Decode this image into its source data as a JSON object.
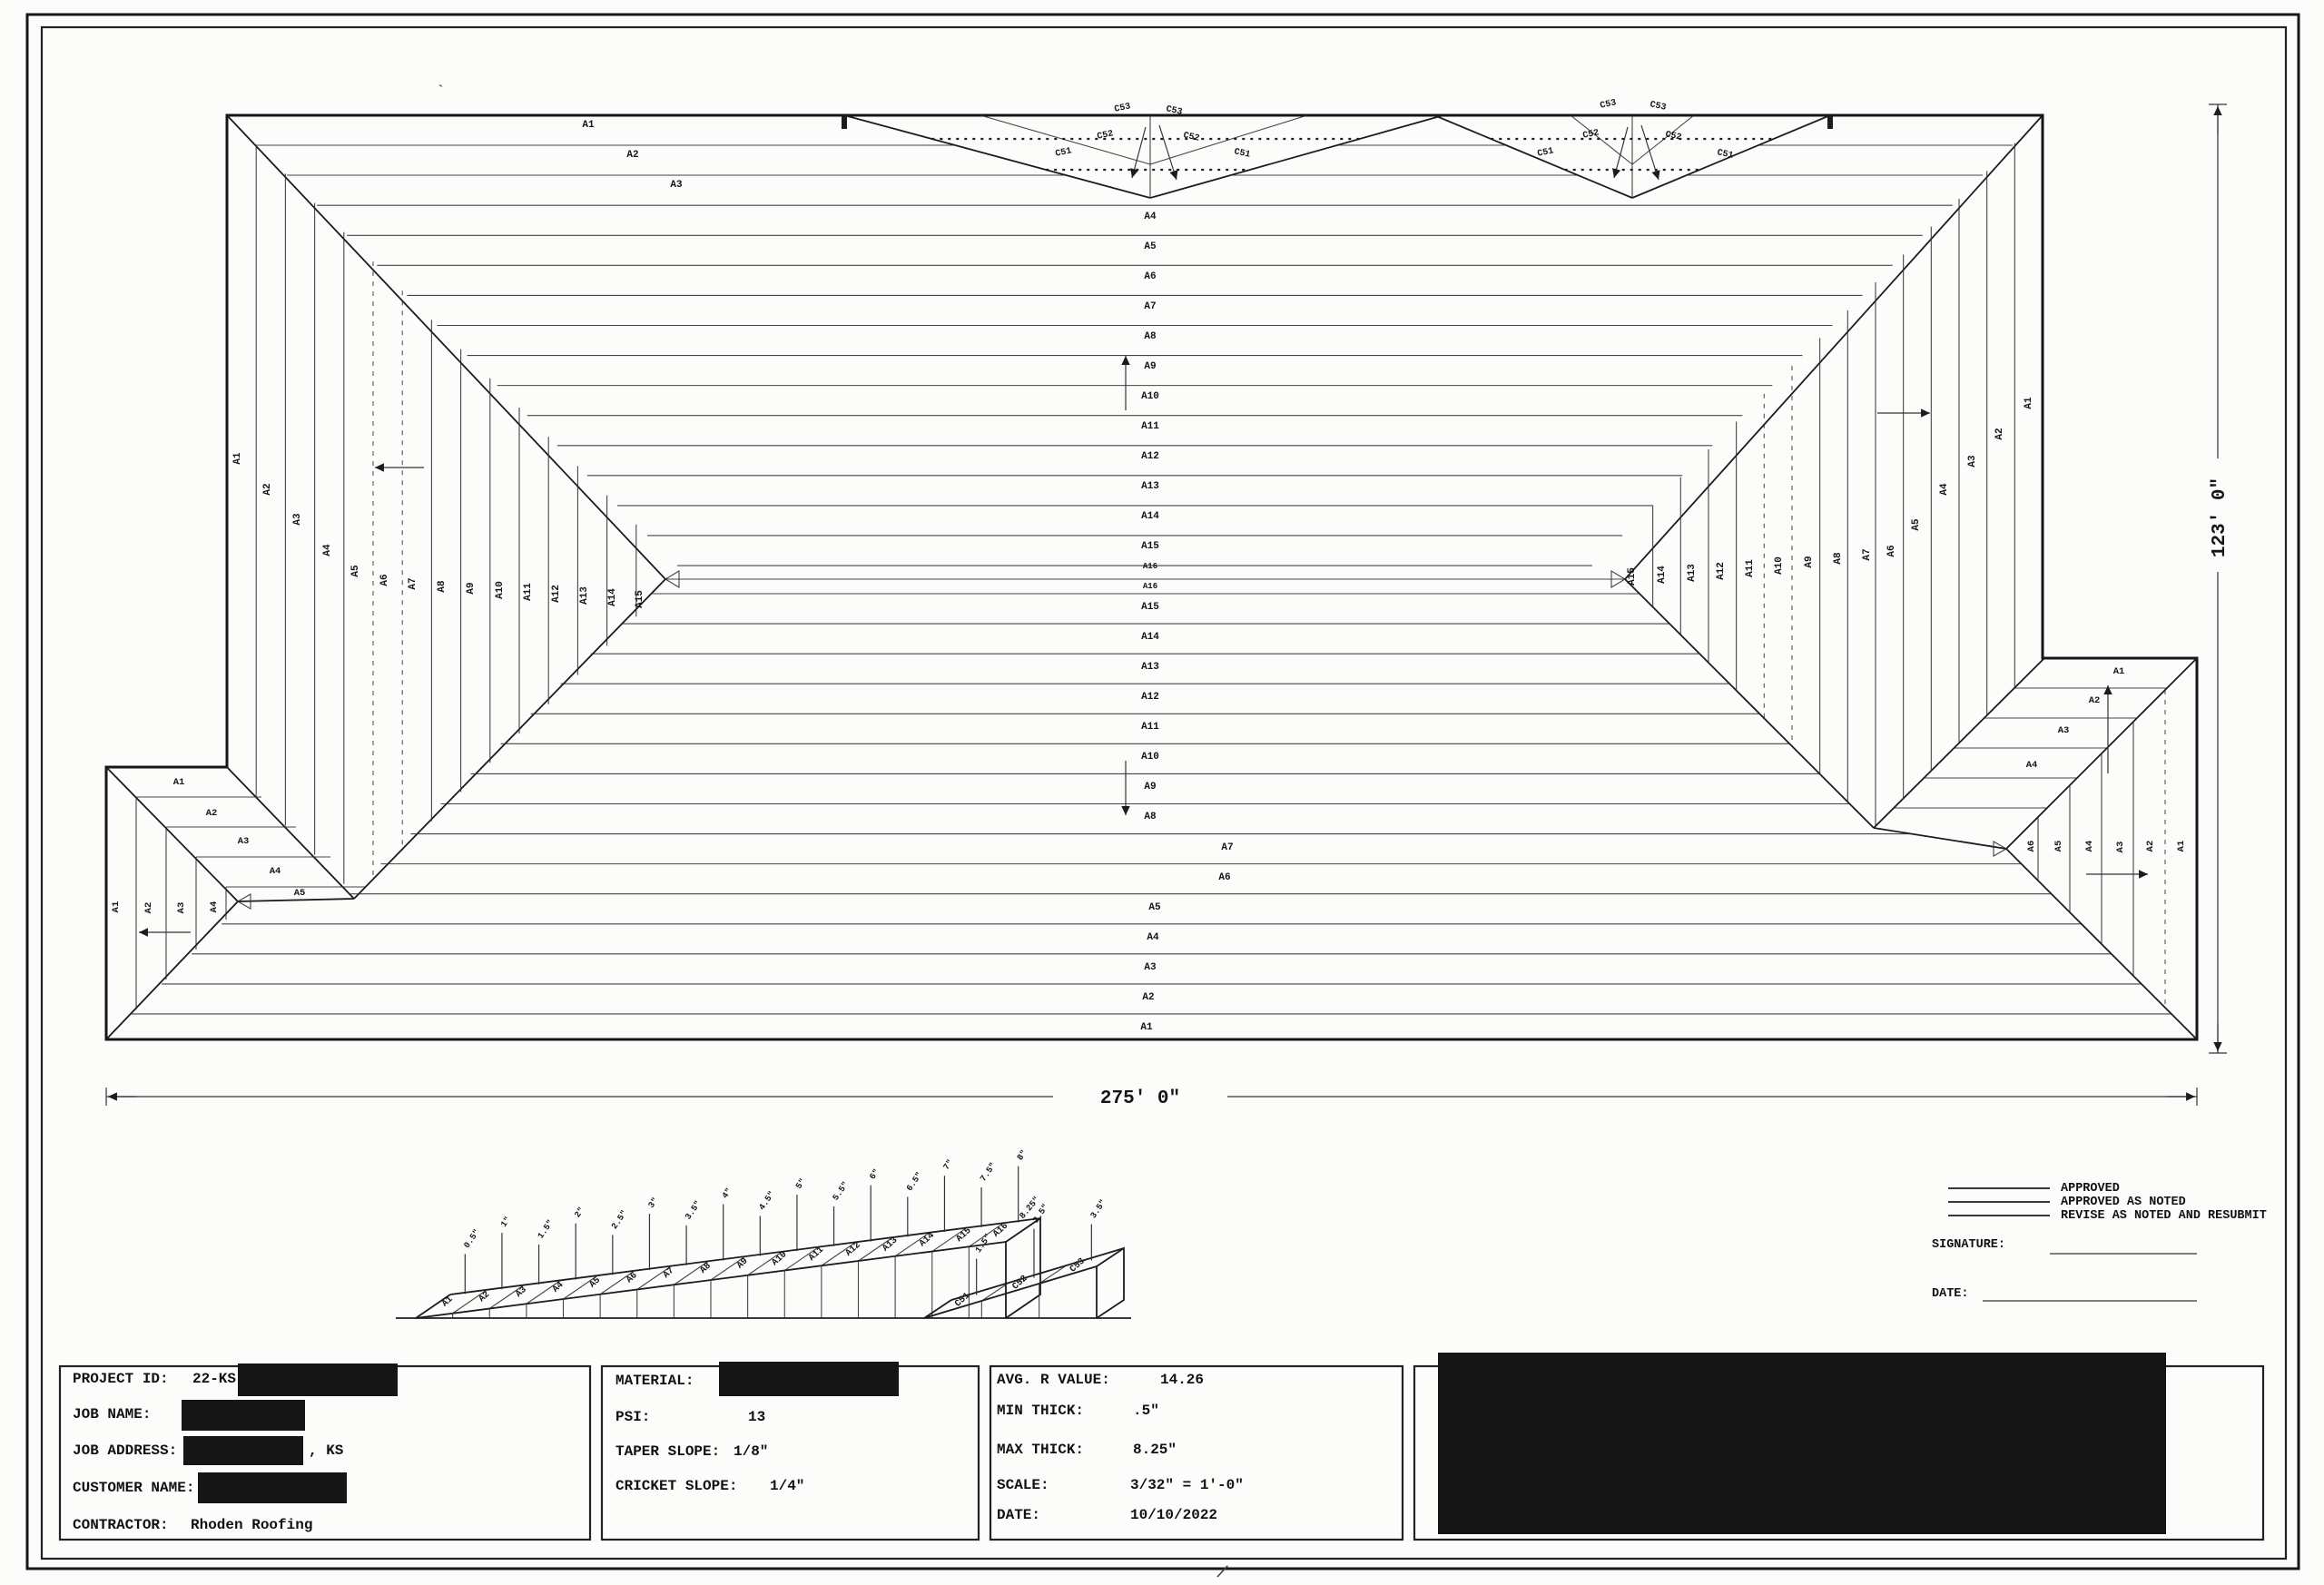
{
  "dims": {
    "width": "275' 0\"",
    "height": "123' 0\""
  },
  "legend": {
    "lines": [
      "APPROVED",
      "APPROVED AS NOTED",
      "REVISE AS NOTED AND RESUBMIT"
    ],
    "signature_label": "SIGNATURE:",
    "date_label": "DATE:"
  },
  "title_block": {
    "project_label": "PROJECT ID:",
    "project_value": "22-KS-",
    "job_name_label": "JOB NAME:",
    "job_address_label": "JOB ADDRESS:",
    "job_address_suffix": ", KS",
    "customer_label": "CUSTOMER NAME:",
    "contractor_label": "CONTRACTOR:",
    "contractor_value": "Rhoden Roofing",
    "material_label": "MATERIAL:",
    "psi_label": "PSI:",
    "psi_value": "13",
    "taper_slope_label": "TAPER SLOPE:",
    "taper_slope_value": "1/8\"",
    "cricket_slope_label": "CRICKET SLOPE:",
    "cricket_slope_value": "1/4\"",
    "avg_r_label": "AVG. R VALUE:",
    "avg_r_value": "14.26",
    "min_thick_label": "MIN THICK:",
    "min_thick_value": ".5\"",
    "max_thick_label": "MAX THICK:",
    "max_thick_value": "8.25\"",
    "scale_label": "SCALE:",
    "scale_value": "3/32\" = 1'-0\"",
    "date_label": "DATE:",
    "date_value": "10/10/2022"
  },
  "plan": {
    "top_stair": [
      "A1",
      "A2",
      "A3"
    ],
    "center_top": [
      "A4",
      "A5",
      "A6",
      "A7",
      "A8",
      "A9",
      "A10",
      "A11",
      "A12",
      "A13",
      "A14",
      "A15",
      "A16",
      "A16"
    ],
    "center_bottom": [
      "A15",
      "A14",
      "A13",
      "A12",
      "A11",
      "A10",
      "A9",
      "A8",
      "A7",
      "A6",
      "A5",
      "A4",
      "A3",
      "A2",
      "A1"
    ],
    "left_fan": [
      "A1",
      "A2",
      "A3",
      "A4",
      "A5",
      "A6",
      "A7",
      "A8",
      "A9",
      "A10",
      "A11",
      "A12",
      "A13",
      "A14",
      "A15"
    ],
    "right_fan": [
      "A15",
      "A14",
      "A13",
      "A12",
      "A11",
      "A10",
      "A9",
      "A8",
      "A7",
      "A6",
      "A5",
      "A4",
      "A3",
      "A2",
      "A1"
    ],
    "notch_top": [
      "A1",
      "A2",
      "A3",
      "A4",
      "A5"
    ],
    "notch_side": [
      "A1",
      "A2",
      "A3",
      "A4"
    ],
    "bump_top": [
      "A1",
      "A2",
      "A3",
      "A4"
    ],
    "bump_side": [
      "A6",
      "A5",
      "A4",
      "A3",
      "A2",
      "A1"
    ],
    "cricket": [
      "C51",
      "C52",
      "C53"
    ]
  },
  "iso": {
    "panels": [
      "A1",
      "A2",
      "A3",
      "A4",
      "A5",
      "A6",
      "A7",
      "A8",
      "A9",
      "A10",
      "A11",
      "A12",
      "A13",
      "A14",
      "A15",
      "A16"
    ],
    "thickness": [
      "0.5\"",
      "1\"",
      "1.5\"",
      "2\"",
      "2.5\"",
      "3\"",
      "3.5\"",
      "4\"",
      "4.5\"",
      "5\"",
      "5.5\"",
      "6\"",
      "6.5\"",
      "7\"",
      "7.5\"",
      "8\""
    ],
    "crickets": [
      "C51",
      "C52",
      "C53"
    ],
    "cricket_thickness": [
      "1.5\"",
      "2.5\"",
      "3.5\""
    ],
    "max_label": "8.25\""
  }
}
